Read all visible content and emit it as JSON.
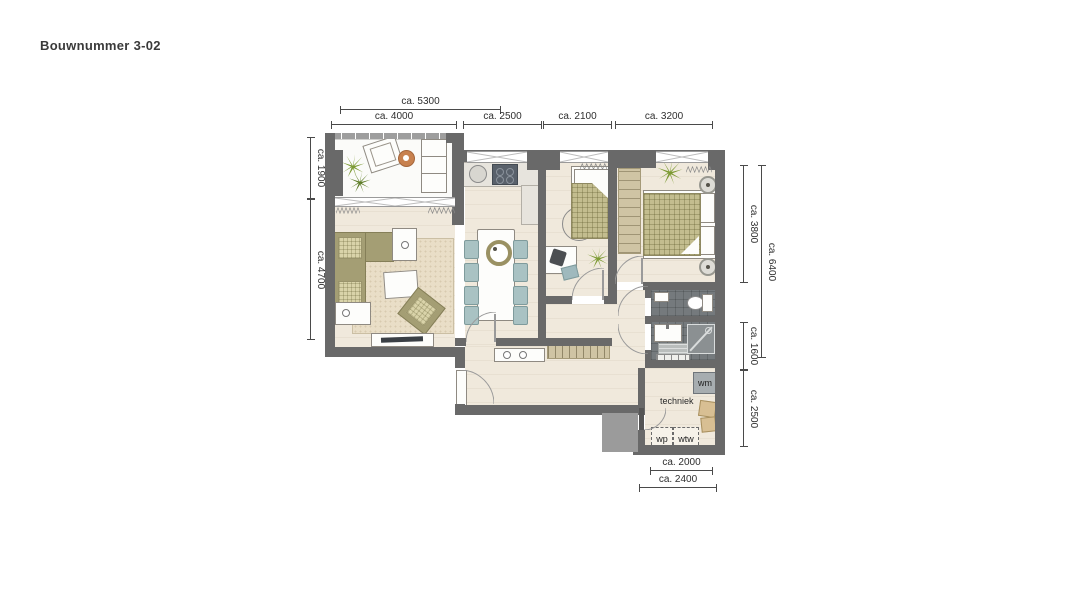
{
  "title": "Bouwnummer 3-02",
  "plan_type": "floor-plan",
  "dims": {
    "t5300": "ca. 5300",
    "t4000": "ca. 4000",
    "t2500": "ca. 2500",
    "t2100": "ca. 2100",
    "t3200": "ca. 3200",
    "l1900": "ca. 1900",
    "l4700": "ca. 4700",
    "r3800": "ca. 3800",
    "r6400": "ca. 6400",
    "r1600": "ca. 1600",
    "r2500": "ca. 2500",
    "b2000": "ca. 2000",
    "b2400": "ca. 2400"
  },
  "labels": {
    "techniek": "techniek",
    "wm": "wm",
    "wp": "wp",
    "wtw": "wtw"
  },
  "colors": {
    "wall": "#696969",
    "floor": "#f0e9dc",
    "bathroom_tile": "#757a7d",
    "sofa_olive": "#a49e74",
    "plaid_light": "#d9d3a9",
    "chair_teal": "#a9c2c3",
    "wood_tan": "#cfc4a4",
    "plant_green": "#7c9a33",
    "side_table_orange": "#c8814f"
  }
}
